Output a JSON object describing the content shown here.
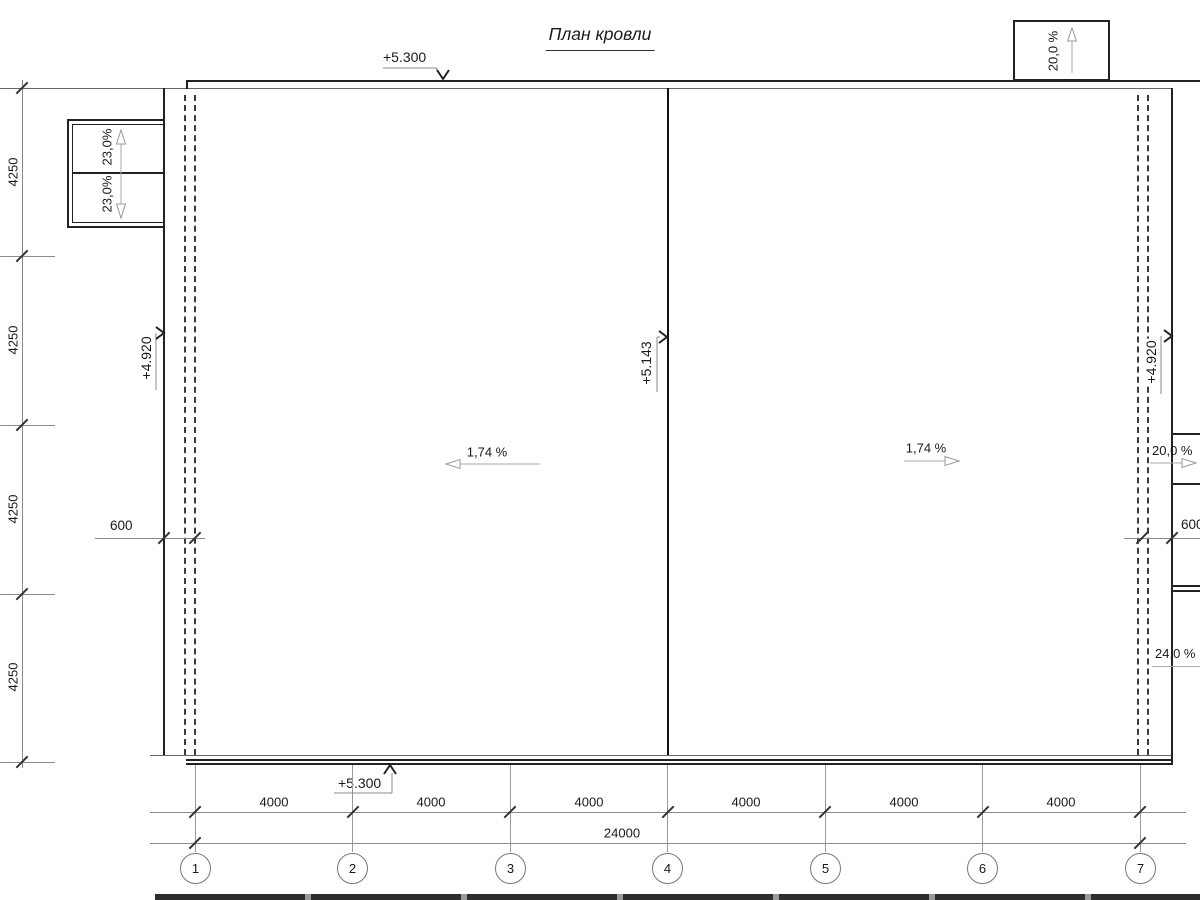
{
  "title": "План кровли",
  "elevations": {
    "roof_top": "+5.300",
    "roof_bottom": "+5.300",
    "ridge": "+5.143",
    "left_eave": "+4.920",
    "right_eave": "+4.920"
  },
  "slopes": {
    "main_left": "1,74 %",
    "main_right": "1,74 %",
    "top_canopy": "20,0 %",
    "left_canopy_upper": "23,0%",
    "left_canopy_lower": "23,0%",
    "right_canopy": "20,0 %",
    "right_ramp": "24,0 %"
  },
  "dimensions": {
    "left_spans": [
      "4250",
      "4250",
      "4250",
      "4250"
    ],
    "bottom_spans": [
      "4000",
      "4000",
      "4000",
      "4000",
      "4000",
      "4000"
    ],
    "bottom_total": "24000",
    "parapet_offset_left": "600",
    "parapet_offset_right": "600"
  },
  "axes": [
    "1",
    "2",
    "3",
    "4",
    "5",
    "6",
    "7"
  ]
}
